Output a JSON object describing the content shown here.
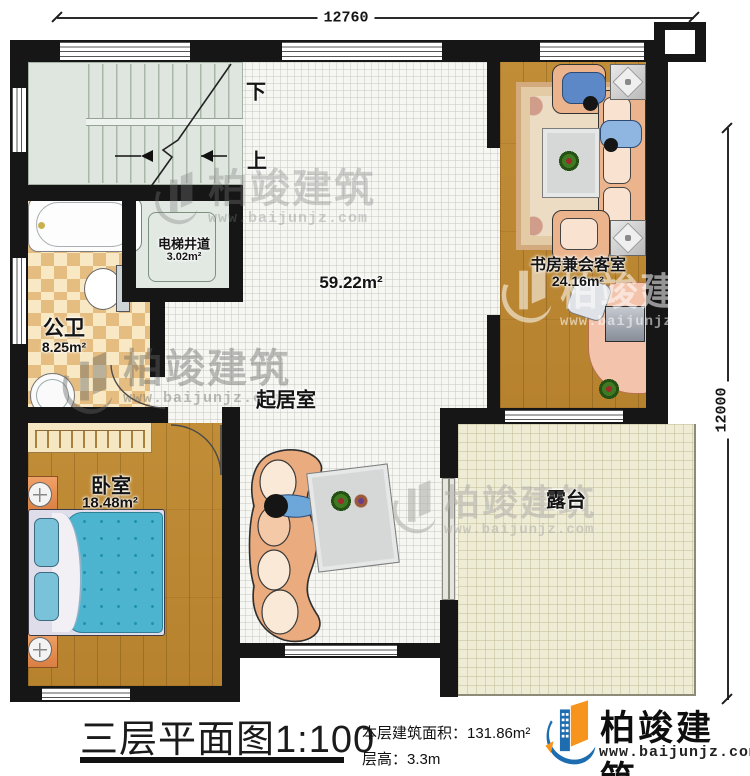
{
  "dimensions": {
    "width_top": "12760",
    "height_right": "12000"
  },
  "stairs": {
    "down": "下",
    "up": "上"
  },
  "rooms": {
    "elevator": {
      "name": "电梯井道",
      "area": "3.02m²"
    },
    "bathroom": {
      "name": "公卫",
      "area": "8.25m²"
    },
    "living": {
      "name": "起居室",
      "area": "59.22m²"
    },
    "study": {
      "name": "书房兼会客室",
      "area": "24.16m²"
    },
    "bedroom": {
      "name": "卧室",
      "area": "18.48m²"
    },
    "terrace": {
      "name": "露台"
    }
  },
  "watermark": {
    "brand": "柏竣建筑",
    "url": "www.baijunjz.com"
  },
  "footer": {
    "title": "三层平面图1:100",
    "area_label": "本层建筑面积：131.86m²",
    "height_label": "层高：3.3m",
    "brand": "柏竣建筑",
    "url": "www.baijunjz.com"
  },
  "colors": {
    "accent_blue": "#1d6db0",
    "accent_orange": "#f7941d",
    "wall": "#161616"
  }
}
